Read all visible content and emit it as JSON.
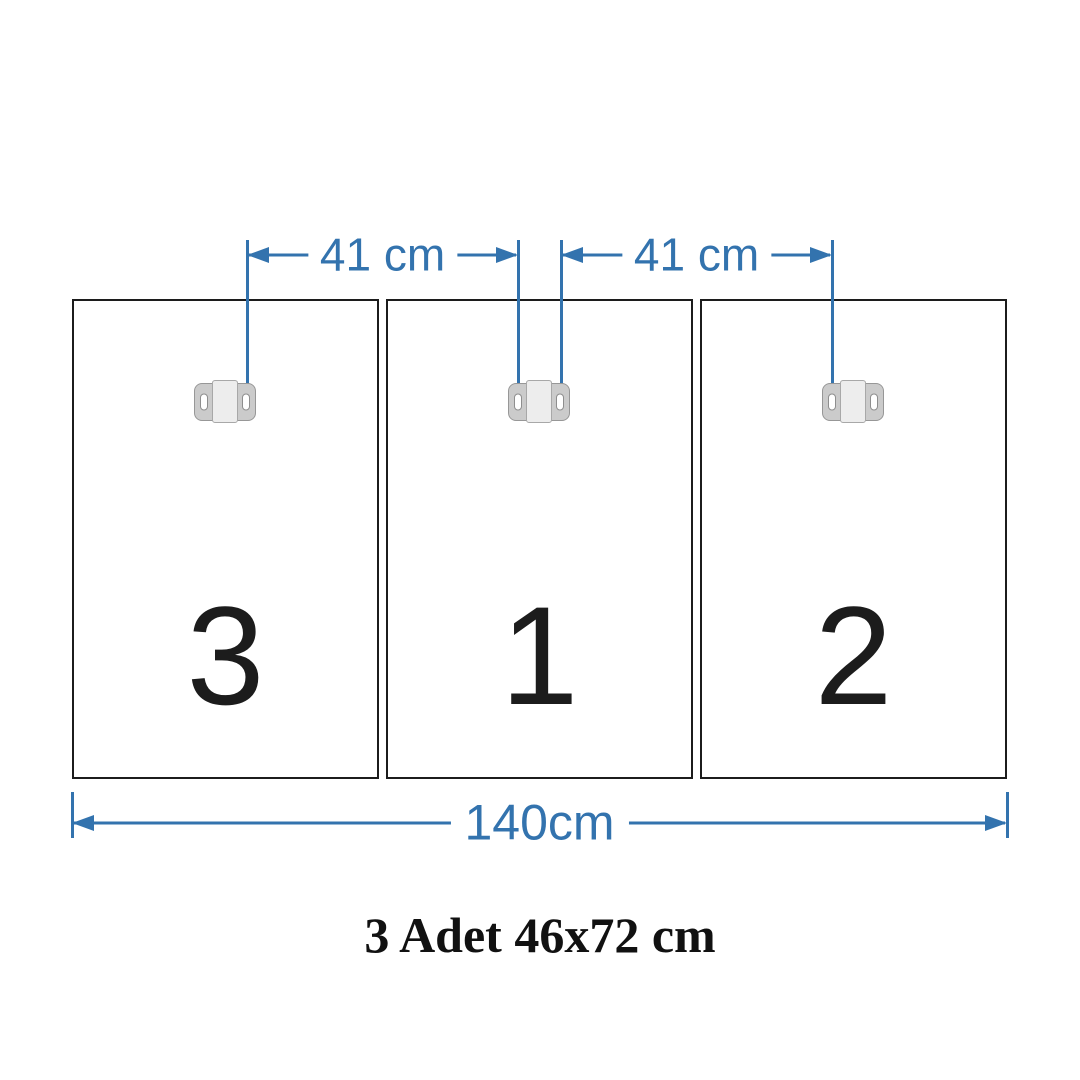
{
  "diagram": {
    "title": "panel hanging dimension diagram",
    "top_dimensions": [
      {
        "label": "41 cm"
      },
      {
        "label": "41 cm"
      }
    ],
    "bottom_dimension": {
      "label": "140cm"
    },
    "panels": [
      {
        "number": "3"
      },
      {
        "number": "1"
      },
      {
        "number": "2"
      }
    ],
    "caption": "3 Adet 46x72 cm",
    "icons": {
      "bracket": "mounting-bracket-icon",
      "arrow_left": "arrow-left-icon",
      "arrow_right": "arrow-right-icon",
      "extension_line": "extension-line",
      "tick": "dimension-end-tick"
    },
    "colors": {
      "dimension_blue": "#3373ae",
      "panel_border_black": "#1c1c1c",
      "number_black": "#1c1c1c",
      "caption_black": "#111111",
      "bracket_fill": "#cbcbcb",
      "bracket_center_fill": "#ededed",
      "bracket_outline": "#979797",
      "background": "#ffffff"
    }
  }
}
